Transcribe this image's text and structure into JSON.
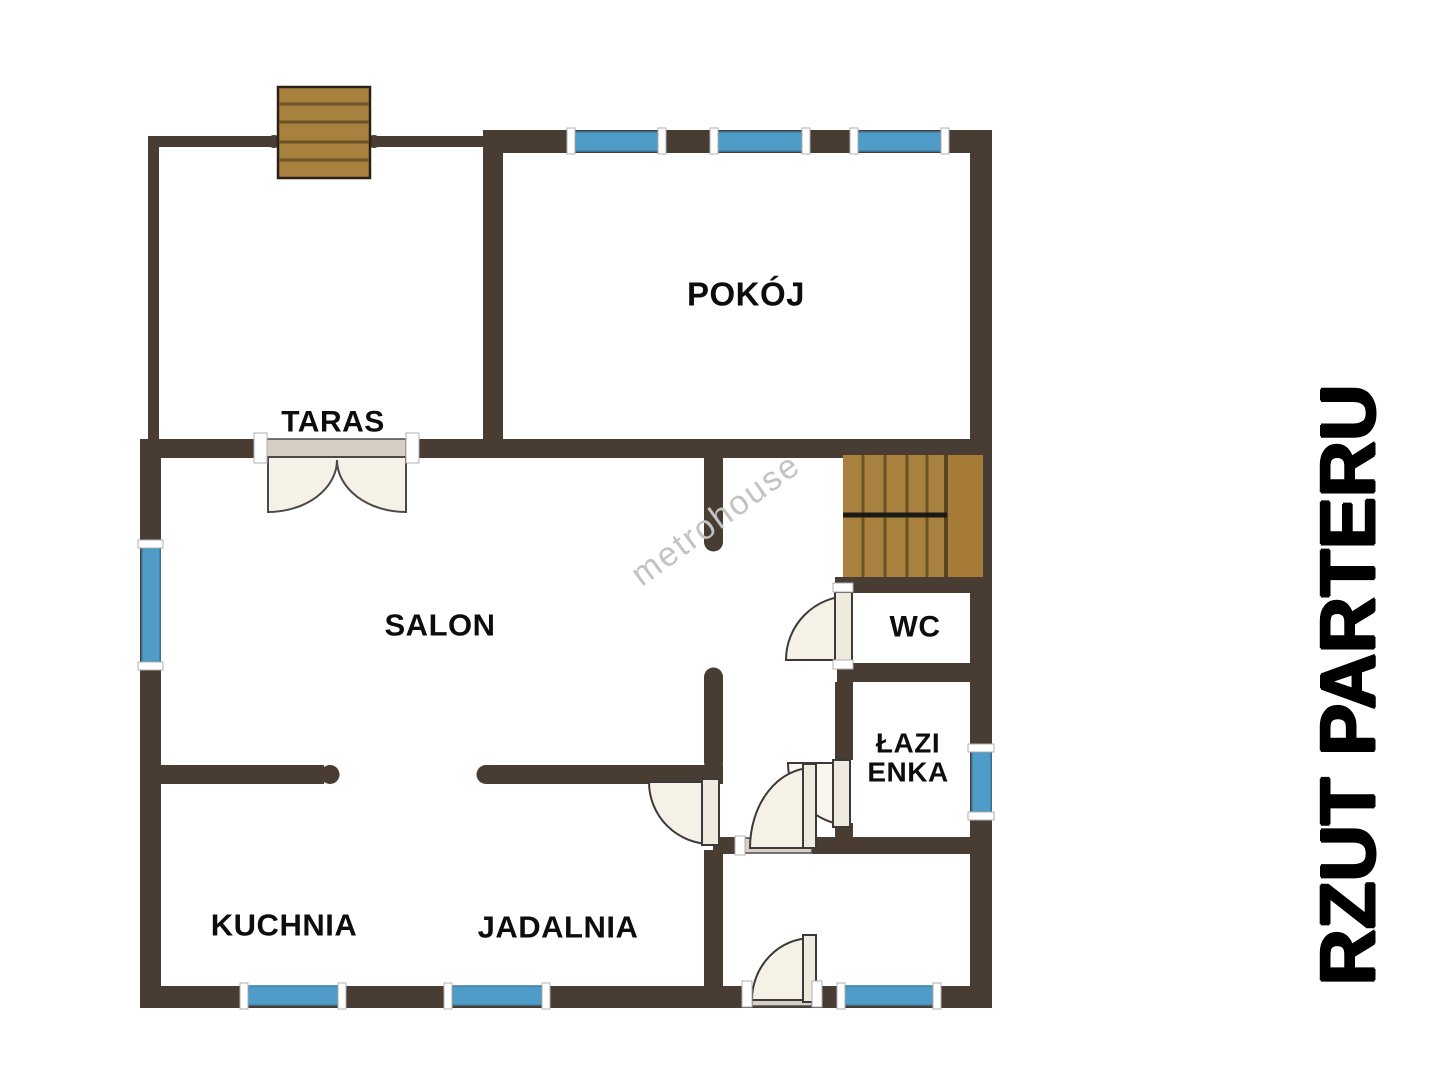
{
  "plan_title": "RZUT PARTERU",
  "watermark": "metrohouse",
  "rooms": {
    "taras": "TARAS",
    "pokoj": "POKÓJ",
    "salon": "SALON",
    "wc": "WC",
    "lazienka_line1": "ŁAZI",
    "lazienka_line2": "ENKA",
    "kuchnia": "KUCHNIA",
    "jadalnia": "JADALNIA"
  },
  "colors": {
    "wall": "#493d33",
    "window_blue": "#4f9cc9",
    "window_border": "#3b7fa6",
    "stair_wood": "#a8813f",
    "stair_wood_dark": "#6b5326",
    "door_fill": "#f6f1e7",
    "threshold": "#d6cfc3",
    "watermark_gray": "#c3c3c3",
    "label_black": "#0d0d0d"
  }
}
